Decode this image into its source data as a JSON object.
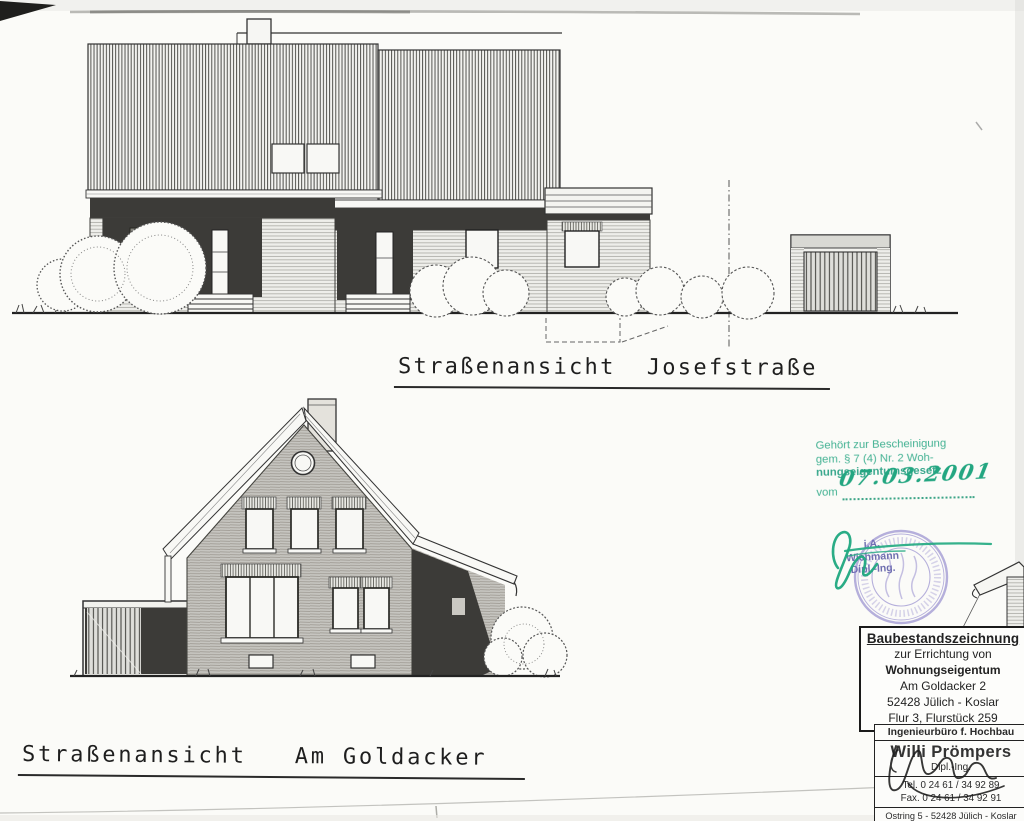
{
  "drawings": {
    "top": {
      "title": "Straßenansicht  Josefstraße"
    },
    "bottom": {
      "title": "Straßenansicht   Am Goldacker"
    }
  },
  "approval_stamp": {
    "color": "#35ac8b",
    "line1": "Gehört zur Bescheinigung",
    "line2": "gem. § 7 (4) Nr. 2 Woh-",
    "line3": "nungseigentumsgesetz",
    "vom_label": "vom",
    "date": "07.03.2001"
  },
  "seal": {
    "color": "#8b80cf",
    "prefix": "i.A.",
    "name_line": "Wichmann",
    "title_line": "Dipl.-Ing."
  },
  "info_box": {
    "title": "Baubestandszeichnung",
    "line1": "zur Errichtung von",
    "line2": "Wohnungseigentum",
    "line3": "Am  Goldacker  2",
    "line4": "52428  Jülich - Koslar",
    "line5": "Flur 3, Flurstück 259"
  },
  "firm_box": {
    "header": "Ingenieurbüro f. Hochbau",
    "name": "Willi Prömpers",
    "degree": "Dipl.-Ing.",
    "tel": "Tel. 0 24 61 / 34 92 89",
    "fax": "Fax. 0 24 61 / 34 92 91",
    "address": "Ostring 5 - 52428 Jülich - Koslar"
  }
}
